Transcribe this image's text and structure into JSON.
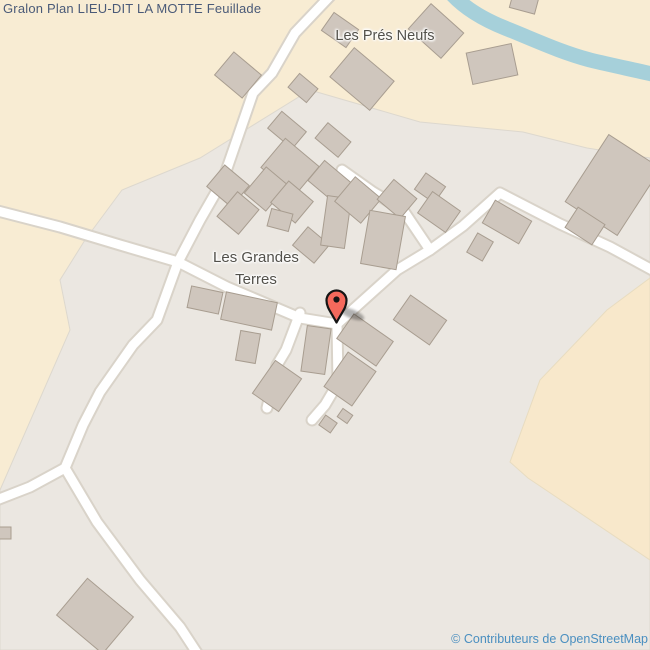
{
  "page": {
    "title": "Gralon Plan LIEU-DIT LA MOTTE Feuillade"
  },
  "map": {
    "labels": {
      "pres_neufs": "Les Prés Neufs",
      "grandes_terres_line1": "Les Grandes",
      "grandes_terres_line2": "Terres"
    },
    "marker": {
      "name": "location-pin",
      "color": "#f4695c"
    },
    "attribution": "© Contributeurs de OpenStreetMap",
    "colors": {
      "farmland": "#f8ecd3",
      "residential": "#ebe7e1",
      "field": "#f8e8cb",
      "river": "#a6d0da",
      "road_fill": "#ffffff",
      "road_casing": "#d9d3c9",
      "building_fill": "#cfc6bd",
      "building_stroke": "#a89d90",
      "title_text": "#4a5a78",
      "label_text": "#52504a",
      "attribution_text": "#4a8fc0"
    }
  }
}
